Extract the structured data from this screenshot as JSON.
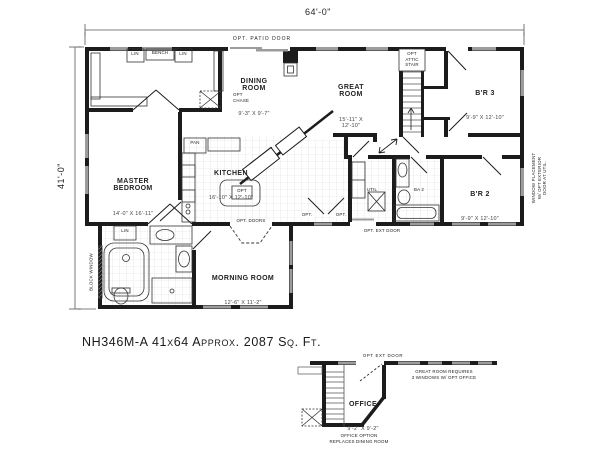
{
  "title": "NH346M-A  41x64 Approx. 2087 Sq. Ft.",
  "dimensions": {
    "width": "64'-0\"",
    "height": "41'-0\""
  },
  "rooms": {
    "dining": {
      "name": "DINING ROOM",
      "dims": "9'-3\" X 9'-7\""
    },
    "great": {
      "name": "GREAT ROOM",
      "dims": "15'-11\" X 12'-10\""
    },
    "br3": {
      "name": "B'R 3",
      "dims": "9'-9\" X 12'-10\""
    },
    "master": {
      "name": "MASTER BEDROOM",
      "dims": "14'-0\" X 16'-11\""
    },
    "kitchen": {
      "name": "KITCHEN",
      "dims": "16'-10\" X 12'-10\""
    },
    "br2": {
      "name": "B'R 2",
      "dims": "9'-9\" X 12'-10\""
    },
    "morning": {
      "name": "MORNING ROOM",
      "dims": "12'-6\" X 11'-2\""
    },
    "util": {
      "name": "UTIL"
    },
    "ba2": {
      "name": "BA 2"
    }
  },
  "annotations": {
    "patio_door": "OPT. PATIO DOOR",
    "attic_stair": "OPT\nATTIC\nSTAIR",
    "opt_chase": "OPT\nCHASE",
    "pantry": "PAN",
    "island": "OPT",
    "opt_doors": "OPT. DOORS",
    "opt_ext_door": "OPT. EXT DOOR",
    "opt": "OPT.",
    "window_note": "WINDOW PLACEMENT\nW/ OPT EXTERIOR\nDOOR AT UTIL.",
    "block_window": "BLOCK WINDOW",
    "lin": "LIN",
    "bench": "BENCH"
  },
  "office_option": {
    "ext_door": "OPT EXT DOOR",
    "room": {
      "name": "OFFICE",
      "dims": "9'-2\" X 9'-2\""
    },
    "note": "GREAT ROOM REQUIRES\n3 WINDOWS W/ OPT OFFICE",
    "caption": "OFFICE OPTION\nREPLACES DINING ROOM"
  }
}
